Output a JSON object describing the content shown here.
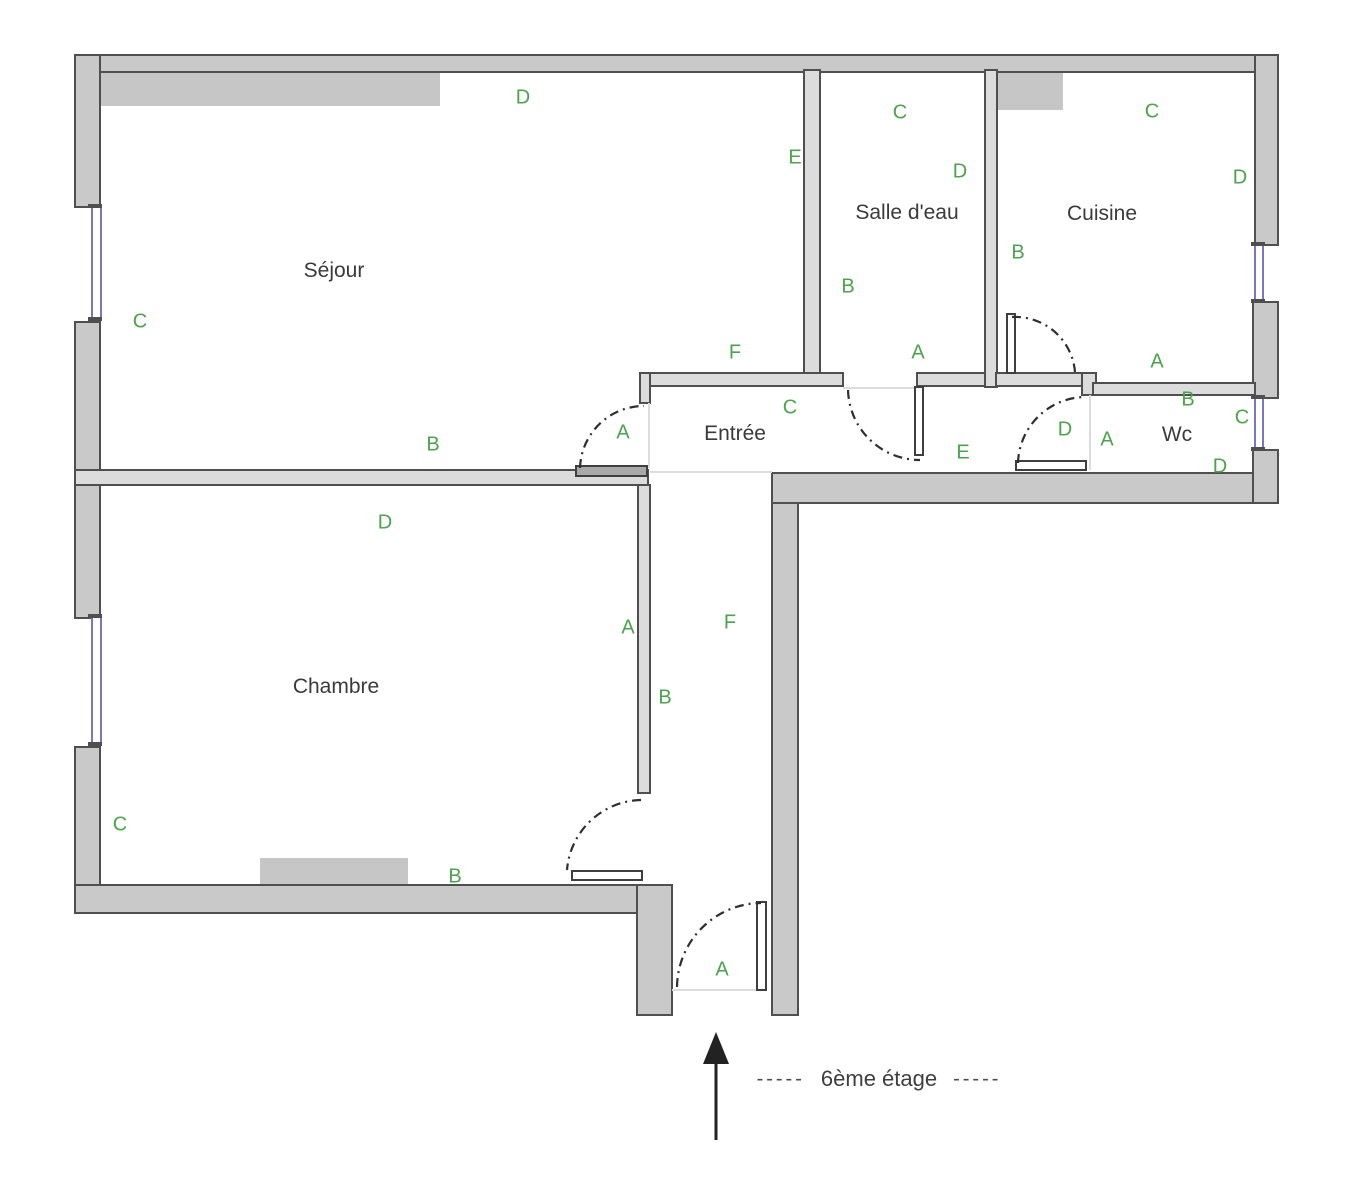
{
  "plan_title": "floor-plan",
  "colors": {
    "wall_fill": "#c9c9c9",
    "interior_wall_fill": "#dcdcdc",
    "wall_stroke": "#4f4f4f",
    "window_blue": "#7777c4",
    "label_green": "#4da34d",
    "text_dark": "#3a3a3a",
    "faint_line": "#dcdcdc"
  },
  "rooms": [
    {
      "name": "Séjour",
      "name_pos": {
        "x": 334,
        "y": 271
      },
      "letters": [
        {
          "ch": "D",
          "x": 523,
          "y": 98
        },
        {
          "ch": "E",
          "x": 795,
          "y": 158
        },
        {
          "ch": "C",
          "x": 140,
          "y": 322
        },
        {
          "ch": "F",
          "x": 735,
          "y": 353
        },
        {
          "ch": "A",
          "x": 623,
          "y": 433
        },
        {
          "ch": "B",
          "x": 433,
          "y": 445
        }
      ]
    },
    {
      "name": "Salle d'eau",
      "name_pos": {
        "x": 907,
        "y": 213
      },
      "letters": [
        {
          "ch": "C",
          "x": 900,
          "y": 113
        },
        {
          "ch": "D",
          "x": 960,
          "y": 172
        },
        {
          "ch": "B",
          "x": 848,
          "y": 287
        },
        {
          "ch": "A",
          "x": 918,
          "y": 353
        }
      ]
    },
    {
      "name": "Cuisine",
      "name_pos": {
        "x": 1102,
        "y": 214
      },
      "letters": [
        {
          "ch": "C",
          "x": 1152,
          "y": 112
        },
        {
          "ch": "D",
          "x": 1240,
          "y": 178
        },
        {
          "ch": "B",
          "x": 1018,
          "y": 253
        },
        {
          "ch": "A",
          "x": 1157,
          "y": 362
        }
      ]
    },
    {
      "name": "Entrée",
      "name_pos": {
        "x": 735,
        "y": 434
      },
      "letters": [
        {
          "ch": "C",
          "x": 790,
          "y": 408
        },
        {
          "ch": "E",
          "x": 963,
          "y": 453
        },
        {
          "ch": "D",
          "x": 1065,
          "y": 430
        },
        {
          "ch": "F",
          "x": 730,
          "y": 623
        },
        {
          "ch": "B",
          "x": 665,
          "y": 698
        },
        {
          "ch": "A",
          "x": 722,
          "y": 970
        }
      ]
    },
    {
      "name": "Wc",
      "name_pos": {
        "x": 1177,
        "y": 435
      },
      "letters": [
        {
          "ch": "B",
          "x": 1188,
          "y": 400
        },
        {
          "ch": "C",
          "x": 1242,
          "y": 418
        },
        {
          "ch": "A",
          "x": 1107,
          "y": 440
        },
        {
          "ch": "D",
          "x": 1220,
          "y": 467
        }
      ]
    },
    {
      "name": "Chambre",
      "name_pos": {
        "x": 336,
        "y": 687
      },
      "letters": [
        {
          "ch": "D",
          "x": 385,
          "y": 523
        },
        {
          "ch": "A",
          "x": 628,
          "y": 628
        },
        {
          "ch": "C",
          "x": 120,
          "y": 825
        },
        {
          "ch": "B",
          "x": 455,
          "y": 877
        }
      ]
    }
  ],
  "floor_label": {
    "dashes_left": "-----",
    "text": "6ème étage",
    "dashes_right": "-----"
  }
}
